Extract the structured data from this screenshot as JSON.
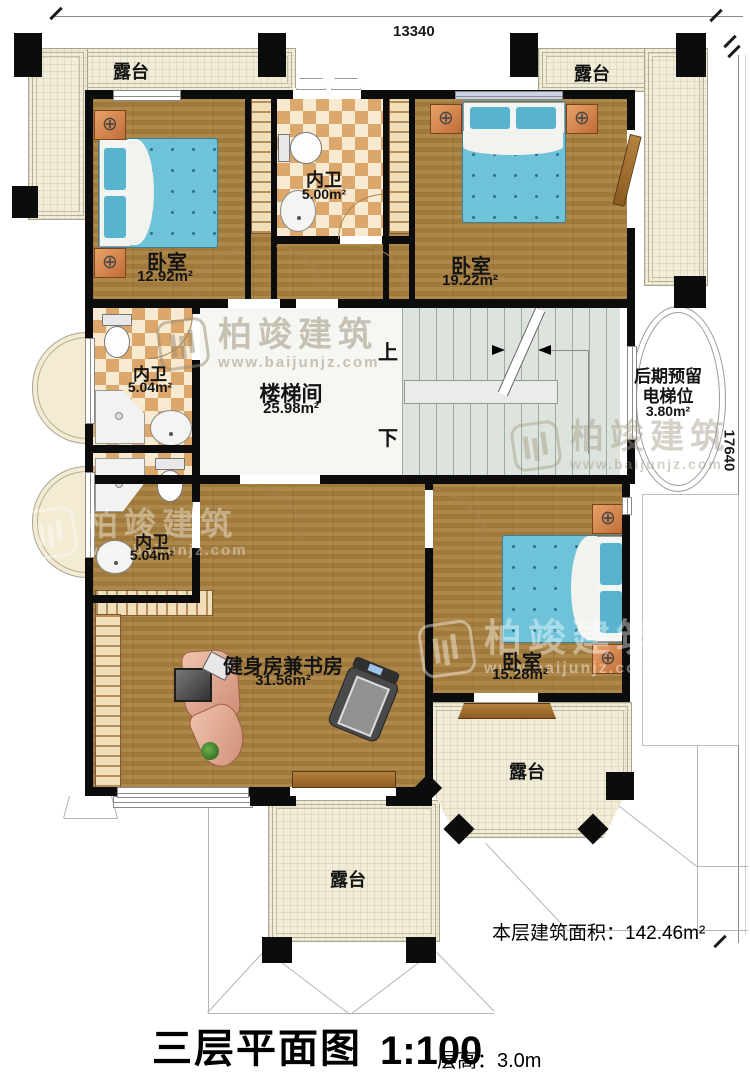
{
  "dimensions": {
    "width_mm": "13340",
    "height_mm": "17640"
  },
  "terraces": {
    "label": "露台"
  },
  "rooms": {
    "bedroom_top_left": {
      "name": "卧室",
      "area": "12.92m²"
    },
    "bath_top": {
      "name": "内卫",
      "area": "5.00m²"
    },
    "bedroom_top_right": {
      "name": "卧室",
      "area": "19.22m²"
    },
    "bath_mid_upper": {
      "name": "内卫",
      "area": "5.04m²"
    },
    "bath_mid_lower": {
      "name": "内卫",
      "area": "5.04m²"
    },
    "stairwell": {
      "name": "楼梯间",
      "area": "25.98m²",
      "up": "上",
      "down": "下"
    },
    "elevator_reserve": {
      "line1": "后期预留",
      "line2": "电梯位",
      "area": "3.80m²"
    },
    "gym_study": {
      "name": "健身房兼书房",
      "area": "31.56m²"
    },
    "bedroom_bottom": {
      "name": "卧室",
      "area": "15.28m²"
    }
  },
  "annotations": {
    "floor_area_label": "本层建筑面积：",
    "floor_area_value": "142.46m²",
    "title": "三层平面图",
    "scale": "1:100",
    "floor_height_label": "层高：",
    "floor_height_value": "3.0m"
  },
  "watermark": {
    "brand": "柏竣建筑",
    "url": "www.baijunjz.com"
  },
  "colors": {
    "wall": "#0c0c0c",
    "wood_floor": "#a9813f",
    "tile_dark": "#dca76a",
    "tile_light": "#f7ead0",
    "terrace": "#f1edd9",
    "stairs": "#dde3dd",
    "bed": "#6fc3d9",
    "desk": "#dfa28b",
    "nightstand": "#d08045"
  }
}
